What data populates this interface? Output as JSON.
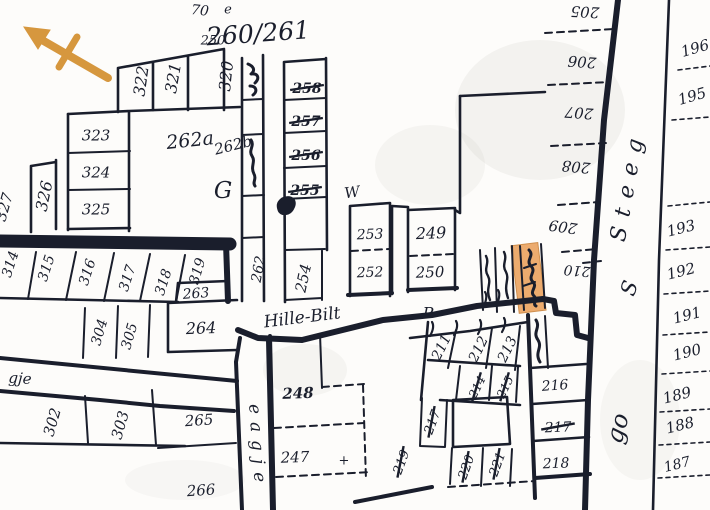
{
  "map": {
    "colors": {
      "ink": "#1a1e2c",
      "paper": "#fdfcfa",
      "compass_orange": "#d6973e",
      "highlight_fill": "#ecab6e"
    },
    "compass": {
      "icon": "north-arrow"
    },
    "highlight": {
      "description": "highlighted-parcel"
    },
    "labels": [
      {
        "text": "322",
        "x": 141,
        "y": 81,
        "rot": -82,
        "size": 16,
        "kind": "plot-number-label"
      },
      {
        "text": "321",
        "x": 173,
        "y": 78,
        "rot": -80,
        "size": 16,
        "kind": "plot-number-label"
      },
      {
        "text": "320",
        "x": 226,
        "y": 76,
        "rot": -84,
        "size": 16,
        "kind": "plot-number-label"
      },
      {
        "text": "323",
        "x": 96,
        "y": 135,
        "rot": 0,
        "size": 15,
        "kind": "plot-number-label"
      },
      {
        "text": "324",
        "x": 96,
        "y": 172,
        "rot": 0,
        "size": 15,
        "kind": "plot-number-label"
      },
      {
        "text": "325",
        "x": 96,
        "y": 209,
        "rot": 0,
        "size": 15,
        "kind": "plot-number-label"
      },
      {
        "text": "326",
        "x": 44,
        "y": 196,
        "rot": -78,
        "size": 16,
        "kind": "plot-number-label"
      },
      {
        "text": "327",
        "x": 4,
        "y": 207,
        "rot": -74,
        "size": 15,
        "kind": "plot-number-label"
      },
      {
        "text": "262a",
        "x": 190,
        "y": 140,
        "rot": -6,
        "size": 19,
        "kind": "plot-number-label",
        "script": true
      },
      {
        "text": "262b",
        "x": 233,
        "y": 145,
        "rot": -14,
        "size": 15,
        "kind": "plot-number-label",
        "script": true
      },
      {
        "text": "G",
        "x": 223,
        "y": 190,
        "rot": 0,
        "size": 23,
        "kind": "letter-mark",
        "script": true
      },
      {
        "text": "250",
        "x": 213,
        "y": 40,
        "rot": 0,
        "size": 13,
        "kind": "plot-number-label"
      },
      {
        "text": "260/261",
        "x": 258,
        "y": 33,
        "rot": -4,
        "size": 25,
        "kind": "map-inscription",
        "script": true
      },
      {
        "text": "70",
        "x": 200,
        "y": 10,
        "rot": 6,
        "size": 14,
        "kind": "map-inscription",
        "script": true
      },
      {
        "text": "e",
        "x": 228,
        "y": 9,
        "rot": 0,
        "size": 13,
        "kind": "letter-mark",
        "script": true
      },
      {
        "text": "258",
        "x": 307,
        "y": 88,
        "rot": 0,
        "size": 14,
        "kind": "plot-number-label",
        "struck": true,
        "bold": true
      },
      {
        "text": "257",
        "x": 306,
        "y": 121,
        "rot": 0,
        "size": 14,
        "kind": "plot-number-label",
        "struck": true,
        "bold": true
      },
      {
        "text": "256",
        "x": 306,
        "y": 155,
        "rot": 0,
        "size": 14,
        "kind": "plot-number-label",
        "struck": true,
        "bold": true
      },
      {
        "text": "255",
        "x": 305,
        "y": 190,
        "rot": 0,
        "size": 14,
        "kind": "plot-number-label",
        "struck": true,
        "bold": true
      },
      {
        "text": "254",
        "x": 303,
        "y": 278,
        "rot": -78,
        "size": 15,
        "kind": "plot-number-label"
      },
      {
        "text": "262",
        "x": 258,
        "y": 269,
        "rot": -80,
        "size": 14,
        "kind": "plot-number-label"
      },
      {
        "text": "314",
        "x": 10,
        "y": 264,
        "rot": -72,
        "size": 14,
        "kind": "plot-number-label"
      },
      {
        "text": "315",
        "x": 46,
        "y": 268,
        "rot": -72,
        "size": 14,
        "kind": "plot-number-label"
      },
      {
        "text": "316",
        "x": 87,
        "y": 272,
        "rot": -72,
        "size": 14,
        "kind": "plot-number-label"
      },
      {
        "text": "317",
        "x": 127,
        "y": 278,
        "rot": -72,
        "size": 14,
        "kind": "plot-number-label"
      },
      {
        "text": "318",
        "x": 163,
        "y": 282,
        "rot": -72,
        "size": 14,
        "kind": "plot-number-label"
      },
      {
        "text": "319",
        "x": 197,
        "y": 271,
        "rot": -74,
        "size": 14,
        "kind": "plot-number-label"
      },
      {
        "text": "263",
        "x": 196,
        "y": 293,
        "rot": -4,
        "size": 14,
        "kind": "plot-number-label"
      },
      {
        "text": "264",
        "x": 201,
        "y": 328,
        "rot": -2,
        "size": 16,
        "kind": "plot-number-label"
      },
      {
        "text": "304",
        "x": 99,
        "y": 332,
        "rot": -74,
        "size": 14,
        "kind": "plot-number-label"
      },
      {
        "text": "305",
        "x": 129,
        "y": 336,
        "rot": -74,
        "size": 14,
        "kind": "plot-number-label"
      },
      {
        "text": "302",
        "x": 52,
        "y": 422,
        "rot": -74,
        "size": 15,
        "kind": "plot-number-label"
      },
      {
        "text": "303",
        "x": 120,
        "y": 425,
        "rot": -74,
        "size": 15,
        "kind": "plot-number-label"
      },
      {
        "text": "265",
        "x": 199,
        "y": 420,
        "rot": -4,
        "size": 15,
        "kind": "plot-number-label"
      },
      {
        "text": "266",
        "x": 201,
        "y": 490,
        "rot": -4,
        "size": 15,
        "kind": "plot-number-label"
      },
      {
        "text": "248",
        "x": 298,
        "y": 393,
        "rot": -2,
        "size": 15,
        "kind": "plot-number-label",
        "bold": true
      },
      {
        "text": "247",
        "x": 295,
        "y": 457,
        "rot": -2,
        "size": 15,
        "kind": "plot-number-label"
      },
      {
        "text": "253",
        "x": 370,
        "y": 234,
        "rot": -2,
        "size": 14,
        "kind": "plot-number-label"
      },
      {
        "text": "252",
        "x": 370,
        "y": 272,
        "rot": -2,
        "size": 14,
        "kind": "plot-number-label"
      },
      {
        "text": "249",
        "x": 431,
        "y": 233,
        "rot": -2,
        "size": 16,
        "kind": "plot-number-label"
      },
      {
        "text": "250",
        "x": 430,
        "y": 272,
        "rot": -2,
        "size": 15,
        "kind": "plot-number-label"
      },
      {
        "text": "W",
        "x": 352,
        "y": 192,
        "rot": -8,
        "size": 15,
        "kind": "letter-mark",
        "script": true
      },
      {
        "text": "P",
        "x": 428,
        "y": 313,
        "rot": 0,
        "size": 16,
        "kind": "letter-mark",
        "script": true
      },
      {
        "text": "Hille-Bilt",
        "x": 302,
        "y": 317,
        "rot": -7,
        "size": 17,
        "kind": "street-name-label",
        "script": true
      },
      {
        "text": "211",
        "x": 441,
        "y": 347,
        "rot": -64,
        "size": 14,
        "kind": "plot-number-label"
      },
      {
        "text": "212",
        "x": 478,
        "y": 349,
        "rot": -64,
        "size": 14,
        "kind": "plot-number-label"
      },
      {
        "text": "213",
        "x": 507,
        "y": 349,
        "rot": -64,
        "size": 14,
        "kind": "plot-number-label"
      },
      {
        "text": "214",
        "x": 477,
        "y": 387,
        "rot": -64,
        "size": 12,
        "kind": "plot-number-label",
        "struck": true
      },
      {
        "text": "215",
        "x": 505,
        "y": 387,
        "rot": -64,
        "size": 12,
        "kind": "plot-number-label",
        "struck": true
      },
      {
        "text": "216",
        "x": 555,
        "y": 385,
        "rot": -4,
        "size": 14,
        "kind": "plot-number-label"
      },
      {
        "text": "217",
        "x": 558,
        "y": 427,
        "rot": -2,
        "size": 14,
        "kind": "plot-number-label",
        "struck": true
      },
      {
        "text": "218",
        "x": 556,
        "y": 463,
        "rot": -2,
        "size": 14,
        "kind": "plot-number-label"
      },
      {
        "text": "217",
        "x": 432,
        "y": 422,
        "rot": -70,
        "size": 13,
        "kind": "plot-number-label",
        "struck": true
      },
      {
        "text": "219",
        "x": 401,
        "y": 462,
        "rot": -70,
        "size": 13,
        "kind": "plot-number-label",
        "struck": true
      },
      {
        "text": "220",
        "x": 466,
        "y": 467,
        "rot": -70,
        "size": 13,
        "kind": "plot-number-label",
        "struck": true
      },
      {
        "text": "221",
        "x": 497,
        "y": 464,
        "rot": -70,
        "size": 13,
        "kind": "plot-number-label",
        "struck": true
      },
      {
        "text": "205",
        "x": 585,
        "y": 12,
        "rot": 183,
        "size": 15,
        "kind": "plot-number-label"
      },
      {
        "text": "206",
        "x": 582,
        "y": 62,
        "rot": 184,
        "size": 15,
        "kind": "plot-number-label"
      },
      {
        "text": "207",
        "x": 579,
        "y": 113,
        "rot": 184,
        "size": 15,
        "kind": "plot-number-label"
      },
      {
        "text": "208",
        "x": 576,
        "y": 167,
        "rot": 185,
        "size": 15,
        "kind": "plot-number-label"
      },
      {
        "text": "209",
        "x": 563,
        "y": 227,
        "rot": 188,
        "size": 15,
        "kind": "plot-number-label"
      },
      {
        "text": "210",
        "x": 577,
        "y": 271,
        "rot": 185,
        "size": 14,
        "kind": "plot-number-label"
      },
      {
        "text": "196",
        "x": 695,
        "y": 48,
        "rot": -16,
        "size": 15,
        "kind": "plot-number-label"
      },
      {
        "text": "195",
        "x": 692,
        "y": 96,
        "rot": -16,
        "size": 15,
        "kind": "plot-number-label"
      },
      {
        "text": "193",
        "x": 681,
        "y": 228,
        "rot": -14,
        "size": 15,
        "kind": "plot-number-label"
      },
      {
        "text": "192",
        "x": 681,
        "y": 271,
        "rot": -14,
        "size": 15,
        "kind": "plot-number-label"
      },
      {
        "text": "191",
        "x": 687,
        "y": 315,
        "rot": -14,
        "size": 15,
        "kind": "plot-number-label"
      },
      {
        "text": "190",
        "x": 687,
        "y": 352,
        "rot": -14,
        "size": 15,
        "kind": "plot-number-label"
      },
      {
        "text": "189",
        "x": 677,
        "y": 395,
        "rot": -14,
        "size": 15,
        "kind": "plot-number-label"
      },
      {
        "text": "188",
        "x": 680,
        "y": 425,
        "rot": -14,
        "size": 15,
        "kind": "plot-number-label"
      },
      {
        "text": "187",
        "x": 677,
        "y": 464,
        "rot": -14,
        "size": 14,
        "kind": "plot-number-label"
      },
      {
        "text": "Steeg",
        "x": 627,
        "y": 185,
        "rot": -80,
        "size": 22,
        "ls": 10,
        "kind": "street-name-label",
        "script": true
      },
      {
        "text": "S",
        "x": 629,
        "y": 288,
        "rot": -72,
        "size": 21,
        "kind": "street-name-label",
        "script": true
      },
      {
        "text": "go",
        "x": 617,
        "y": 428,
        "rot": -75,
        "size": 24,
        "kind": "street-name-label",
        "script": true
      },
      {
        "text": "eagje",
        "x": 258,
        "y": 447,
        "rot": 86,
        "size": 17,
        "ls": 8,
        "kind": "street-name-label",
        "script": true
      },
      {
        "text": "gje",
        "x": 20,
        "y": 378,
        "rot": 4,
        "size": 15,
        "kind": "street-name-label",
        "script": true
      },
      {
        "text": "+",
        "x": 344,
        "y": 460,
        "rot": 0,
        "size": 13,
        "kind": "letter-mark"
      }
    ]
  }
}
